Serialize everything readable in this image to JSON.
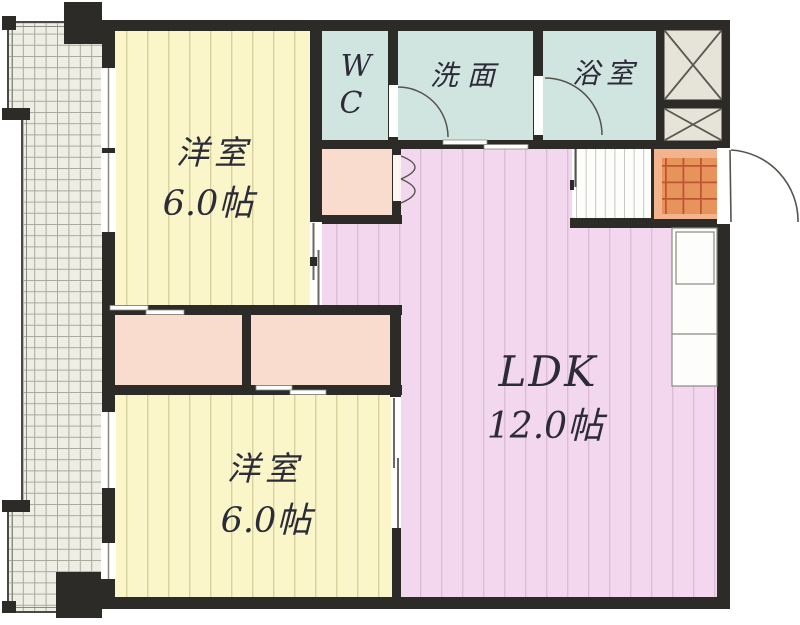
{
  "plan": {
    "rooms": {
      "bedroom_top": {
        "label": "洋室",
        "size": "6.0帖"
      },
      "bedroom_bottom": {
        "label": "洋室",
        "size": "6.0帖"
      },
      "ldk": {
        "label": "LDK",
        "size": "12.0帖"
      },
      "wc": {
        "line1": "W",
        "line2": "C"
      },
      "washroom": {
        "label": "洗面"
      },
      "bath": {
        "label": "浴室"
      }
    },
    "colors": {
      "wall": "#2d2b27",
      "bedroom_fill": "#faf6ca",
      "bedroom_stripe": "#d8d1a0",
      "ldk_fill": "#f2d7ee",
      "ldk_stripe": "#dcbcd8",
      "wet_area_fill": "#d0e4e0",
      "closet_fill": "#f9dcce",
      "entrance_tile": "#e8925c",
      "entrance_step": "#f3b38c",
      "shaft_fill": "#e6e3d8",
      "balcony_fill": "#eeeee5",
      "hall_fill": "#fdfdfb",
      "line": "#55534c"
    }
  }
}
